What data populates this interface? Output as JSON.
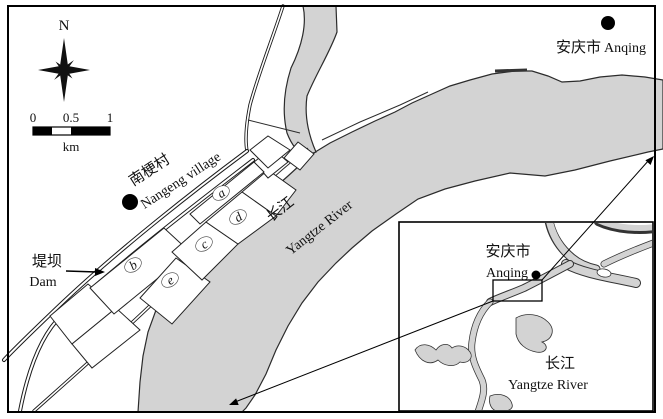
{
  "map": {
    "north_label": "N",
    "scale": {
      "tick0": "0",
      "tick1": "0.5",
      "tick2": "1",
      "unit": "km"
    },
    "city": {
      "zh": "安庆市",
      "en": "Anqing"
    },
    "village": {
      "zh": "南梗村",
      "en": "Nangeng village"
    },
    "dam": {
      "zh": "堤坝",
      "en": "Dam"
    },
    "river": {
      "zh": "长江",
      "en": "Yangtze River"
    },
    "plots": {
      "a": "a",
      "b": "b",
      "c": "c",
      "d": "d",
      "e": "e"
    },
    "inset": {
      "city_zh": "安庆市",
      "city_en": "Anqing",
      "river_zh": "长江",
      "river_en": "Yangtze River"
    },
    "colors": {
      "water": "#d3d3d3",
      "outline": "#2b2b2b",
      "plot_d_bg": "#c4c4c4",
      "plot_e_bg": "#666666"
    }
  }
}
